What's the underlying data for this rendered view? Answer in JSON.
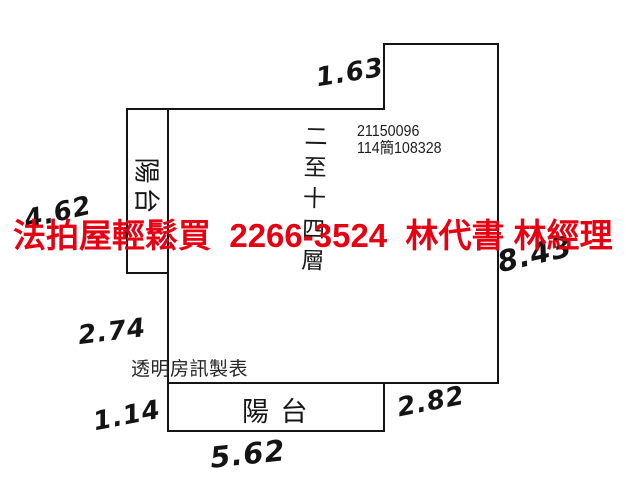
{
  "banner": {
    "text": "法拍屋輕鬆買  2266-3524  林代書 林經理",
    "color": "#e60012"
  },
  "plan": {
    "case_number": "21150096",
    "case_ref": "114簡108328",
    "floor_range_vertical": "二至十四層",
    "side_balcony_label": "陽台",
    "bottom_balcony_label": "陽 台",
    "credit": "透明房訊製表",
    "dims": {
      "top_notch": "1.63",
      "left_upper": "4.62",
      "left_middle": "2.74",
      "left_lower": "1.14",
      "bottom": "5.62",
      "bottom_right": "2.82",
      "right_side": "8.43"
    }
  },
  "colors": {
    "background": "#ffffff",
    "line_black": "#141414",
    "banner_red": "#e60012"
  }
}
